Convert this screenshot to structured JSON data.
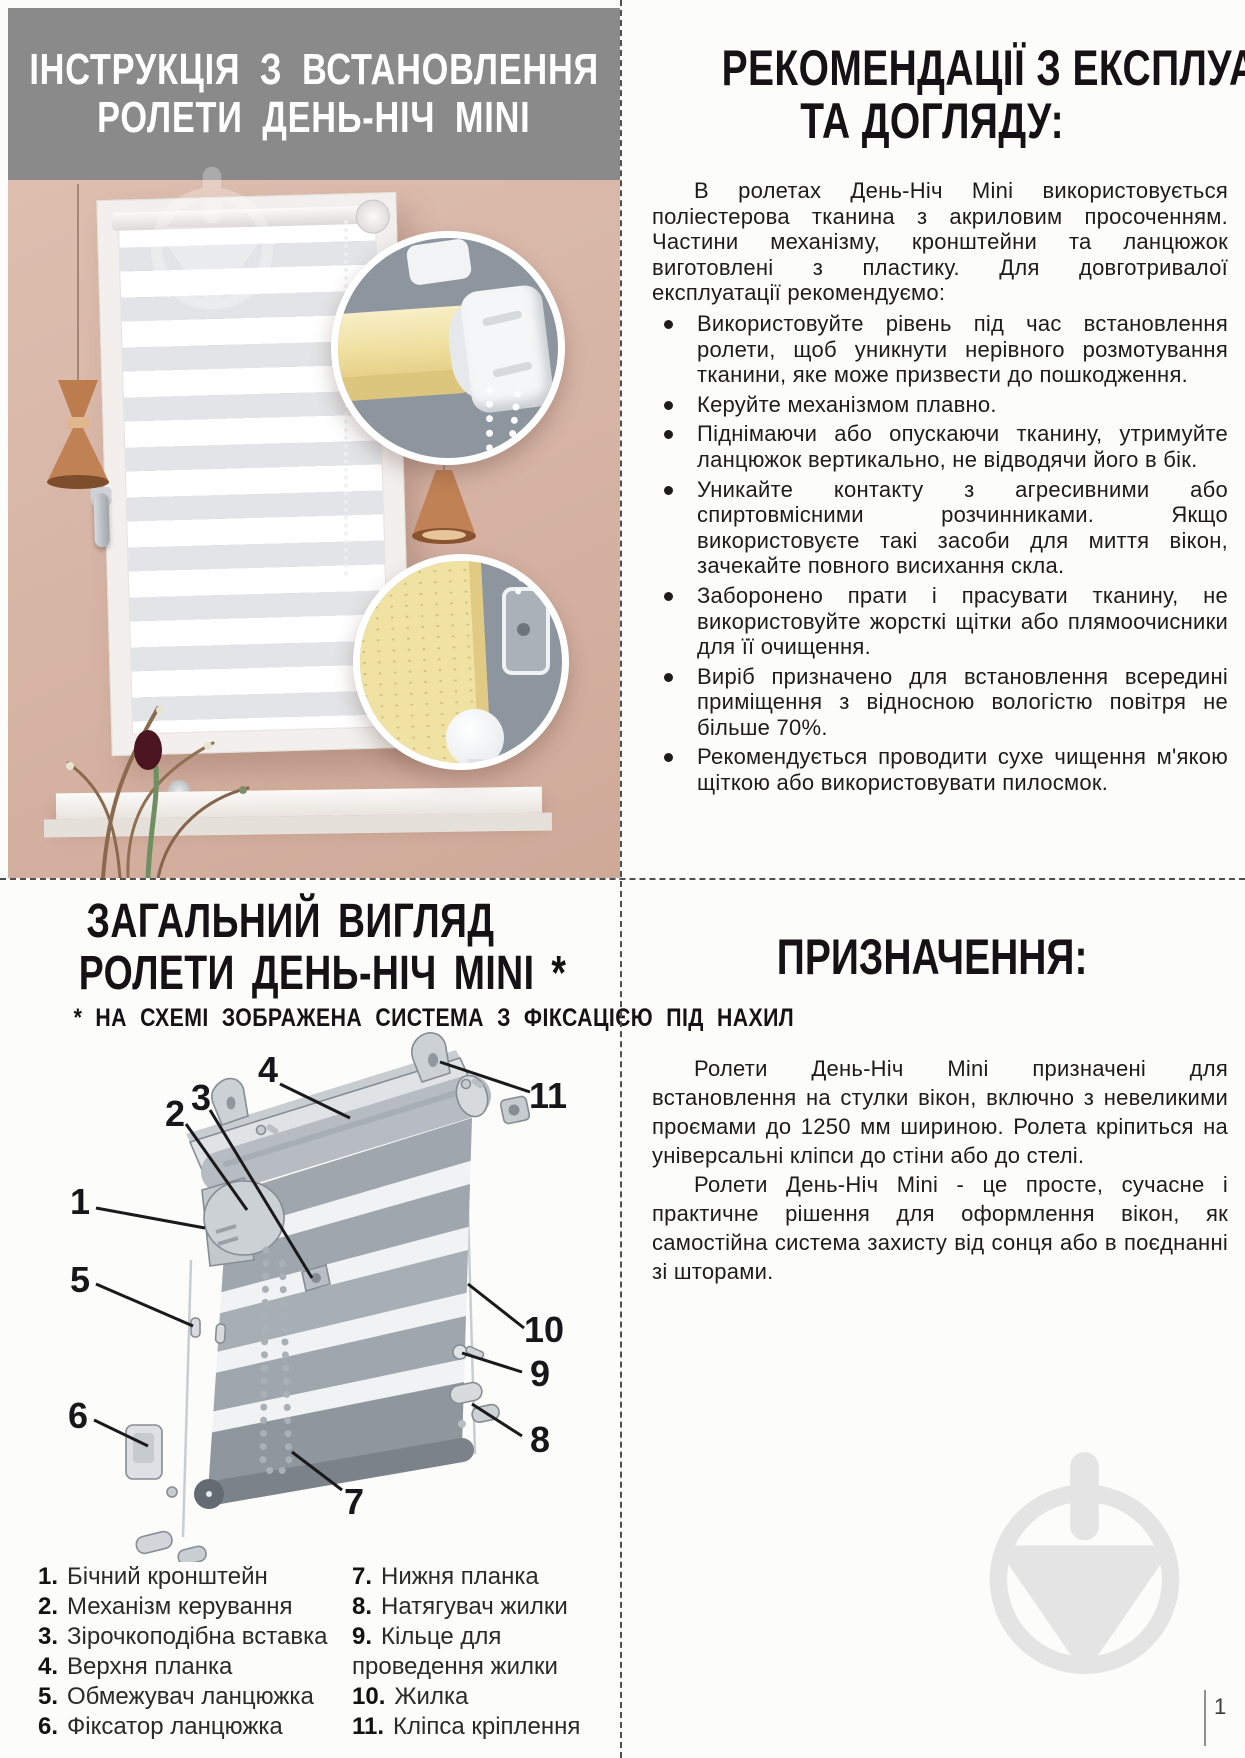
{
  "page": {
    "number": "1"
  },
  "installation_header": {
    "line1": "ІНСТРУКЦІЯ З ВСТАНОВЛЕННЯ",
    "line2": "РОЛЕТИ ДЕНЬ-НІЧ MINI"
  },
  "recommendations": {
    "heading_line1": "РЕКОМЕНДАЦІЇ З ЕКСПЛУАТАЦІЇ",
    "heading_line2": "ТА ДОГЛЯДУ:",
    "intro": "В ролетах День-Ніч Mini використовується поліестерова тканина з акриловим просоченням. Частини механізму, кронштейни та ланцюжок виготовлені з пластику. Для довготривалої експлуатації рекомендуємо:",
    "bullets": [
      "Використовуйте рівень під час встановлення ролети, щоб уникнути нерівного розмотування тканини, яке може призвести до пошкодження.",
      "Керуйте механізмом плавно.",
      "Піднімаючи або опускаючи тканину, утримуйте ланцюжок вертикально, не відводячи його в бік.",
      "Уникайте контакту з агресивними або спиртовмісними розчинниками. Якщо використовуєте такі засоби для миття вікон, зачекайте повного висихання скла.",
      "Заборонено прати і прасувати тканину, не використовуйте жорсткі щітки або плямоочисники для її очищення.",
      "Виріб призначено для встановлення всередині приміщення з відносною вологістю повітря не більше 70%.",
      "Рекомендується проводити сухе чищення м'якою щіткою або використовувати пилосмок."
    ]
  },
  "overview": {
    "heading_line1": "ЗАГАЛЬНИЙ ВИГЛЯД",
    "heading_line2": "РОЛЕТИ ДЕНЬ-НІЧ MINI *",
    "footnote": "* НА СХЕМІ ЗОБРАЖЕНА СИСТЕМА З ФІКСАЦІЄЮ ПІД НАХИЛ",
    "callouts": [
      "1",
      "2",
      "3",
      "4",
      "5",
      "6",
      "7",
      "8",
      "9",
      "10",
      "11"
    ],
    "legend_left": [
      {
        "num": "1.",
        "label": "Бічний кронштейн"
      },
      {
        "num": "2.",
        "label": "Механізм керування"
      },
      {
        "num": "3.",
        "label": "Зірочкоподібна вставка"
      },
      {
        "num": "4.",
        "label": "Верхня планка"
      },
      {
        "num": "5.",
        "label": "Обмежувач ланцюжка"
      },
      {
        "num": "6.",
        "label": "Фіксатор ланцюжка"
      }
    ],
    "legend_right": [
      {
        "num": "7.",
        "label": "Нижня планка"
      },
      {
        "num": "8.",
        "label": "Натягувач жилки"
      },
      {
        "num": "9.",
        "label": "Кільце для\nпроведення жилки"
      },
      {
        "num": "10.",
        "label": "Жилка"
      },
      {
        "num": "11.",
        "label": "Кліпса кріплення"
      }
    ]
  },
  "purpose": {
    "heading": "ПРИЗНАЧЕННЯ:",
    "para1": "Ролети День-Ніч Mini призначені для встановлення на стулки вікон, включно з невеликими проємами до 1250 мм шириною. Ролета кріпиться на універсальні кліпси до стіни або до стелі.",
    "para2": "Ролети День-Ніч Mini - це просте, сучасне і практичне рішення для оформлення вікон, як самостійна система захисту від сонця або в поєднанні зі шторами."
  },
  "colors": {
    "header_bg": "#8a8a8a",
    "wall": "#d8b7a8",
    "inset_bg": "#8d969e",
    "blind_yellow": "#f0e2a4",
    "watermark_gray": "#e4e4e4",
    "text": "#1d1b1c"
  }
}
